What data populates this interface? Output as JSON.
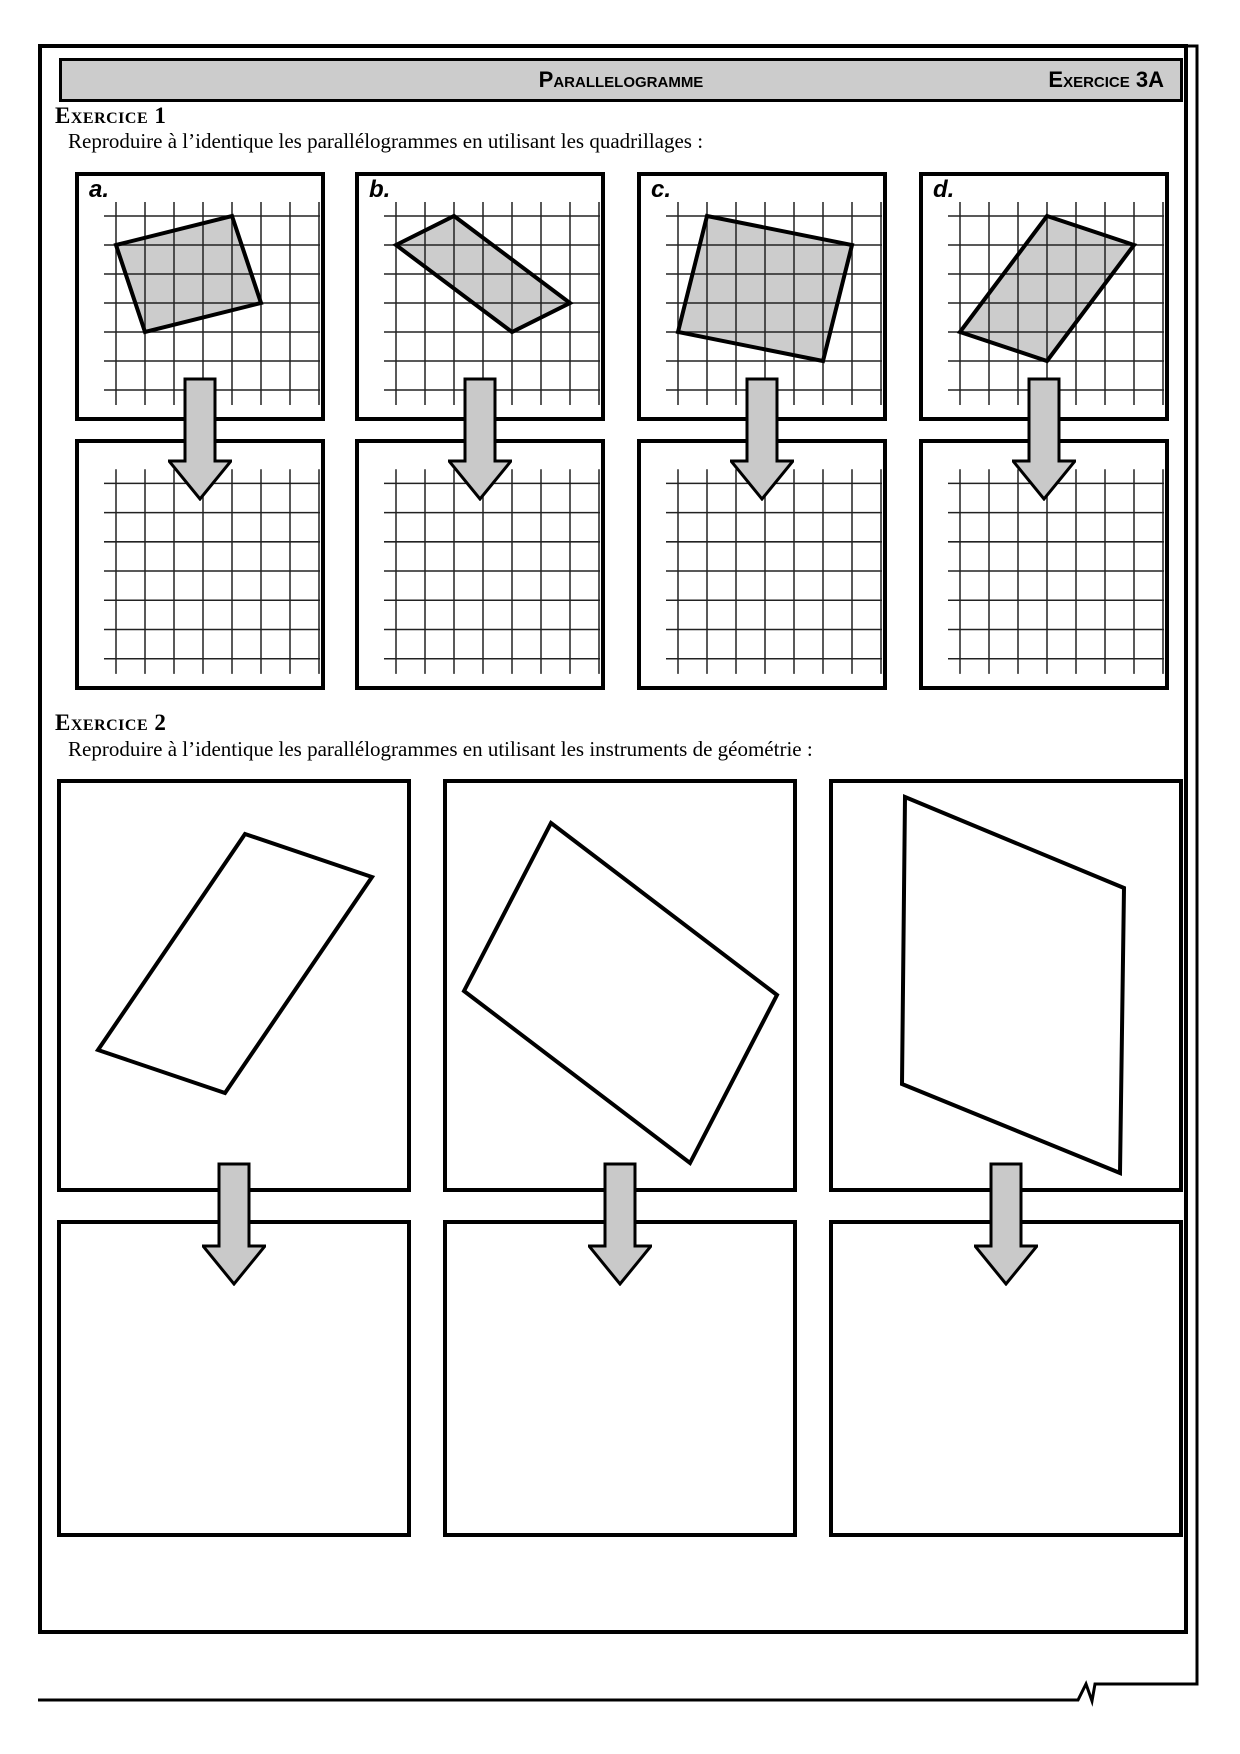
{
  "header": {
    "title": "Parallelogramme",
    "exercise_ref": "Exercice 3A"
  },
  "exercise1": {
    "heading": "Exercice 1",
    "instruction": "Reproduire à l’identique les parallélogrammes en utilisant les quadrillages :",
    "grid": {
      "cols": 8,
      "rows": 7,
      "cell_px": 29
    },
    "items": [
      {
        "label": "a.",
        "vertices": [
          [
            0,
            1
          ],
          [
            4,
            0
          ],
          [
            5,
            3
          ],
          [
            1,
            4
          ]
        ]
      },
      {
        "label": "b.",
        "vertices": [
          [
            0,
            1
          ],
          [
            2,
            0
          ],
          [
            6,
            3
          ],
          [
            4,
            4
          ]
        ]
      },
      {
        "label": "c.",
        "vertices": [
          [
            1,
            0
          ],
          [
            6,
            1
          ],
          [
            5,
            5
          ],
          [
            0,
            4
          ]
        ]
      },
      {
        "label": "d.",
        "vertices": [
          [
            3,
            0
          ],
          [
            6,
            1
          ],
          [
            3,
            5
          ],
          [
            0,
            4
          ]
        ]
      }
    ]
  },
  "exercise2": {
    "heading": "Exercice 2",
    "instruction": "Reproduire à l’identique les parallélogrammes en utilisant les instruments de géométrie :",
    "items": [
      {
        "vertices_px": [
          [
            184,
            51
          ],
          [
            311,
            94
          ],
          [
            164,
            310
          ],
          [
            37,
            267
          ]
        ]
      },
      {
        "vertices_px": [
          [
            104,
            40
          ],
          [
            330,
            212
          ],
          [
            243,
            380
          ],
          [
            17,
            208
          ]
        ]
      },
      {
        "vertices_px": [
          [
            72,
            14
          ],
          [
            291,
            105
          ],
          [
            287,
            390
          ],
          [
            69,
            301
          ]
        ]
      }
    ]
  },
  "colors": {
    "shape_fill": "#cccccc",
    "header_fill": "#cccccc",
    "arrow_fill": "#c9c9c9",
    "grid_line": "#222222"
  }
}
